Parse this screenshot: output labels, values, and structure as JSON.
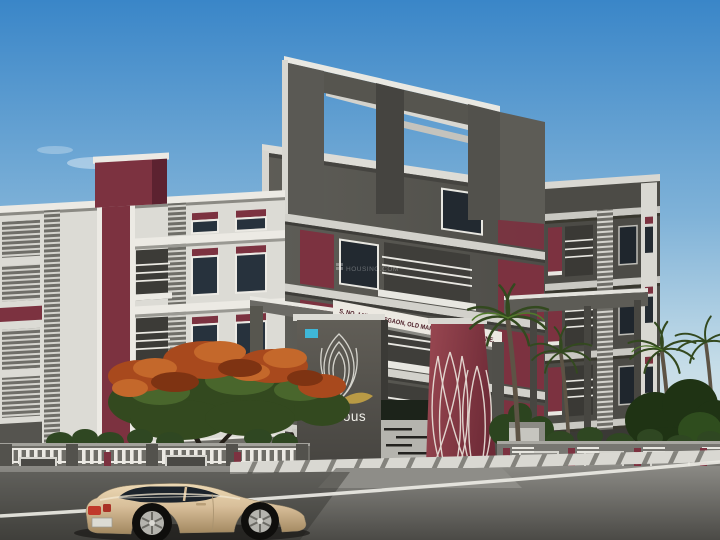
{
  "scene": {
    "watermark": "HOUSING.COM"
  },
  "signage": {
    "address_text": "S. NO. 14/2/3, SUSGAON, OLD MAHALUNGE ROAD, PUNE."
  },
  "branding": {
    "project_name": "Glorious",
    "logo": "lotus-line-art"
  },
  "colors": {
    "sky_top": "#3a86c8",
    "sky_horizon": "#e6e8e1",
    "building_gray": "#57564f",
    "building_gray_dark": "#4c4b46",
    "facade_white": "#dcdbd5",
    "accent_maroon": "#7c3240",
    "maroon_wall_light": "#9a4852",
    "maroon_wall_dark": "#6d2a36",
    "signage_text": "#4a1c26",
    "name_white": "#f0efe9",
    "logo_gold": "#b99a45",
    "railing_white": "#e8e7e1",
    "road": "#8b8a85",
    "road_dark": "#4b4a46",
    "car_body": "#d8bf9a",
    "foliage_green": "#33491f",
    "flower_orange": "#a8491d"
  }
}
